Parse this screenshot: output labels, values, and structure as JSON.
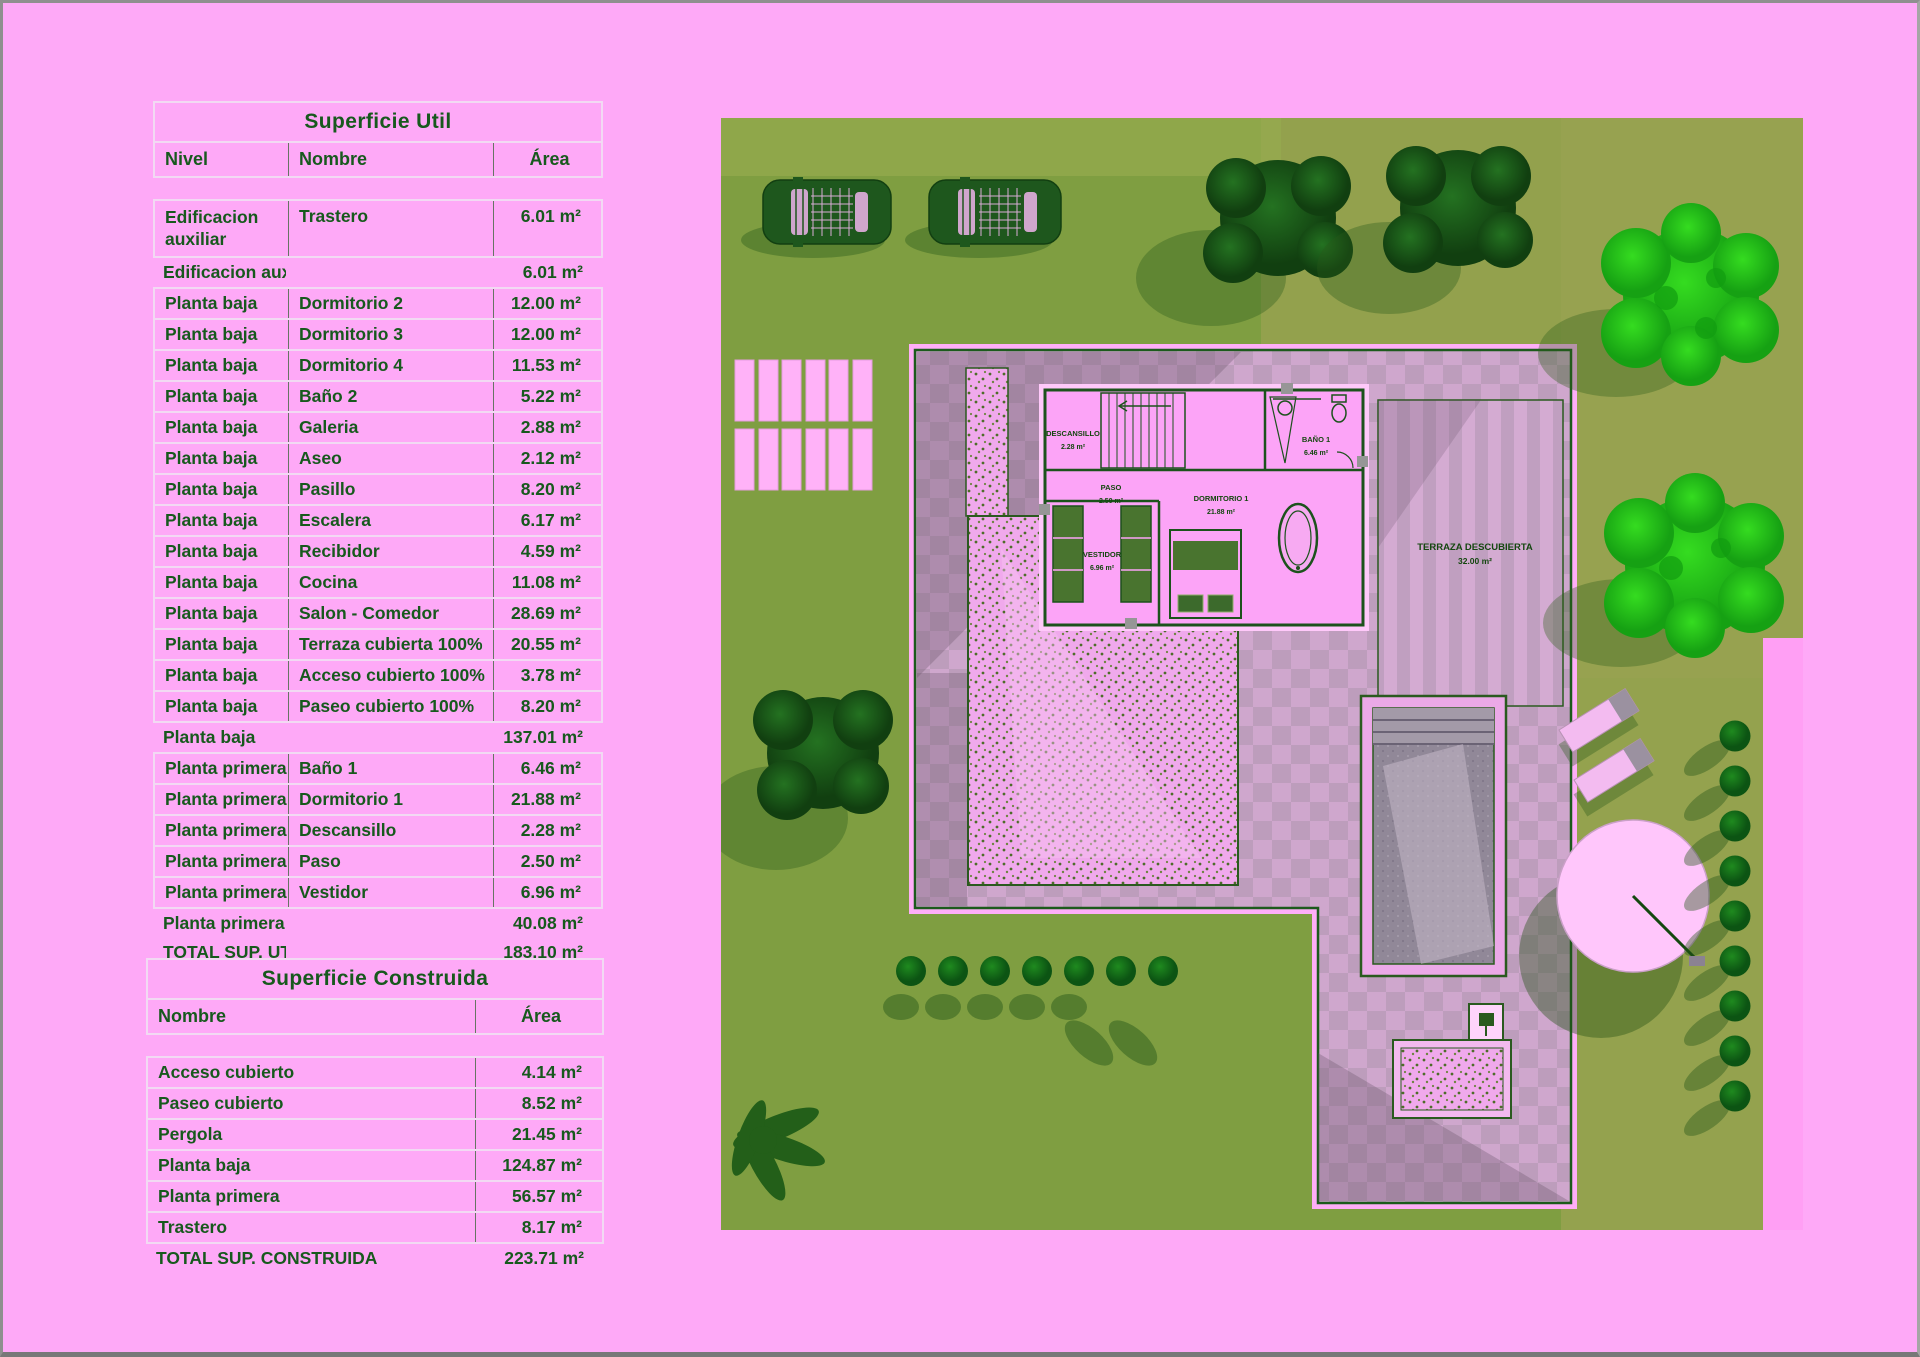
{
  "page": {
    "background": "#fea9f7",
    "text_green": "#17591d"
  },
  "superficie_util": {
    "title": "Superficie Util",
    "columns": {
      "nivel": "Nivel",
      "nombre": "Nombre",
      "area": "Área"
    },
    "rows": [
      {
        "type": "data",
        "tall": true,
        "nivel": "Edificacion auxiliar",
        "nombre": "Trastero",
        "area": "6.01 m²"
      },
      {
        "type": "subtotal",
        "nivel": "Edificacion auxiliar",
        "nombre": "",
        "area": "6.01 m²"
      },
      {
        "type": "data",
        "nivel": "Planta baja",
        "nombre": "Dormitorio 2",
        "area": "12.00 m²"
      },
      {
        "type": "data",
        "nivel": "Planta baja",
        "nombre": "Dormitorio 3",
        "area": "12.00 m²"
      },
      {
        "type": "data",
        "nivel": "Planta baja",
        "nombre": "Dormitorio 4",
        "area": "11.53 m²"
      },
      {
        "type": "data",
        "nivel": "Planta baja",
        "nombre": "Baño 2",
        "area": "5.22 m²"
      },
      {
        "type": "data",
        "nivel": "Planta baja",
        "nombre": "Galeria",
        "area": "2.88 m²"
      },
      {
        "type": "data",
        "nivel": "Planta baja",
        "nombre": "Aseo",
        "area": "2.12 m²"
      },
      {
        "type": "data",
        "nivel": "Planta baja",
        "nombre": "Pasillo",
        "area": "8.20 m²"
      },
      {
        "type": "data",
        "nivel": "Planta baja",
        "nombre": "Escalera",
        "area": "6.17 m²"
      },
      {
        "type": "data",
        "nivel": "Planta baja",
        "nombre": "Recibidor",
        "area": "4.59 m²"
      },
      {
        "type": "data",
        "nivel": "Planta baja",
        "nombre": "Cocina",
        "area": "11.08 m²"
      },
      {
        "type": "data",
        "nivel": "Planta baja",
        "nombre": "Salon - Comedor",
        "area": "28.69 m²"
      },
      {
        "type": "data",
        "nivel": "Planta baja",
        "nombre": "Terraza cubierta 100%",
        "area": "20.55 m²"
      },
      {
        "type": "data",
        "nivel": "Planta baja",
        "nombre": "Acceso cubierto 100%",
        "area": "3.78 m²"
      },
      {
        "type": "data",
        "nivel": "Planta baja",
        "nombre": "Paseo cubierto 100%",
        "area": "8.20 m²"
      },
      {
        "type": "subtotal",
        "nivel": "Planta baja",
        "nombre": "",
        "area": "137.01 m²"
      },
      {
        "type": "data",
        "nivel": "Planta primera",
        "nombre": "Baño 1",
        "area": "6.46 m²"
      },
      {
        "type": "data",
        "nivel": "Planta primera",
        "nombre": "Dormitorio 1",
        "area": "21.88 m²"
      },
      {
        "type": "data",
        "nivel": "Planta primera",
        "nombre": "Descansillo",
        "area": "2.28 m²"
      },
      {
        "type": "data",
        "nivel": "Planta primera",
        "nombre": "Paso",
        "area": "2.50 m²"
      },
      {
        "type": "data",
        "nivel": "Planta primera",
        "nombre": "Vestidor",
        "area": "6.96 m²"
      },
      {
        "type": "subtotal",
        "nivel": "Planta primera",
        "nombre": "",
        "area": "40.08 m²"
      },
      {
        "type": "total",
        "nivel": "TOTAL SUP. UTIL",
        "nombre": "",
        "area": "183.10 m²"
      }
    ]
  },
  "superficie_construida": {
    "title": "Superficie Construida",
    "columns": {
      "nombre": "Nombre",
      "area": "Área"
    },
    "rows": [
      {
        "type": "data",
        "nombre": "Acceso cubierto",
        "area": "4.14 m²"
      },
      {
        "type": "data",
        "nombre": "Paseo cubierto",
        "area": "8.52 m²"
      },
      {
        "type": "data",
        "nombre": "Pergola",
        "area": "21.45 m²"
      },
      {
        "type": "data",
        "nombre": "Planta baja",
        "area": "124.87 m²"
      },
      {
        "type": "data",
        "nombre": "Planta primera",
        "area": "56.57 m²"
      },
      {
        "type": "data",
        "nombre": "Trastero",
        "area": "8.17 m²"
      },
      {
        "type": "total",
        "nombre": "TOTAL SUP. CONSTRUIDA",
        "area": "223.71 m²"
      }
    ]
  },
  "site_plan": {
    "rooms": {
      "descansillo": {
        "name": "DESCANSILLO",
        "area": "2.28 m²"
      },
      "paso": {
        "name": "PASO",
        "area": "2.50 m²"
      },
      "dormitorio1": {
        "name": "DORMITORIO 1",
        "area": "21.88 m²"
      },
      "bano1": {
        "name": "BAÑO 1",
        "area": "6.46 m²"
      },
      "vestidor": {
        "name": "VESTIDOR",
        "area": "6.96 m²"
      },
      "terraza_descubierta": {
        "name": "TERRAZA DESCUBIERTA",
        "area": "32.00 m²"
      }
    },
    "colors": {
      "grass": "#7f9e41",
      "tree_bright": "#2bd01a",
      "tree_dark": "#1b5f16",
      "terrace_tile": "#c9a4c7",
      "pool_water": "#918898"
    }
  }
}
